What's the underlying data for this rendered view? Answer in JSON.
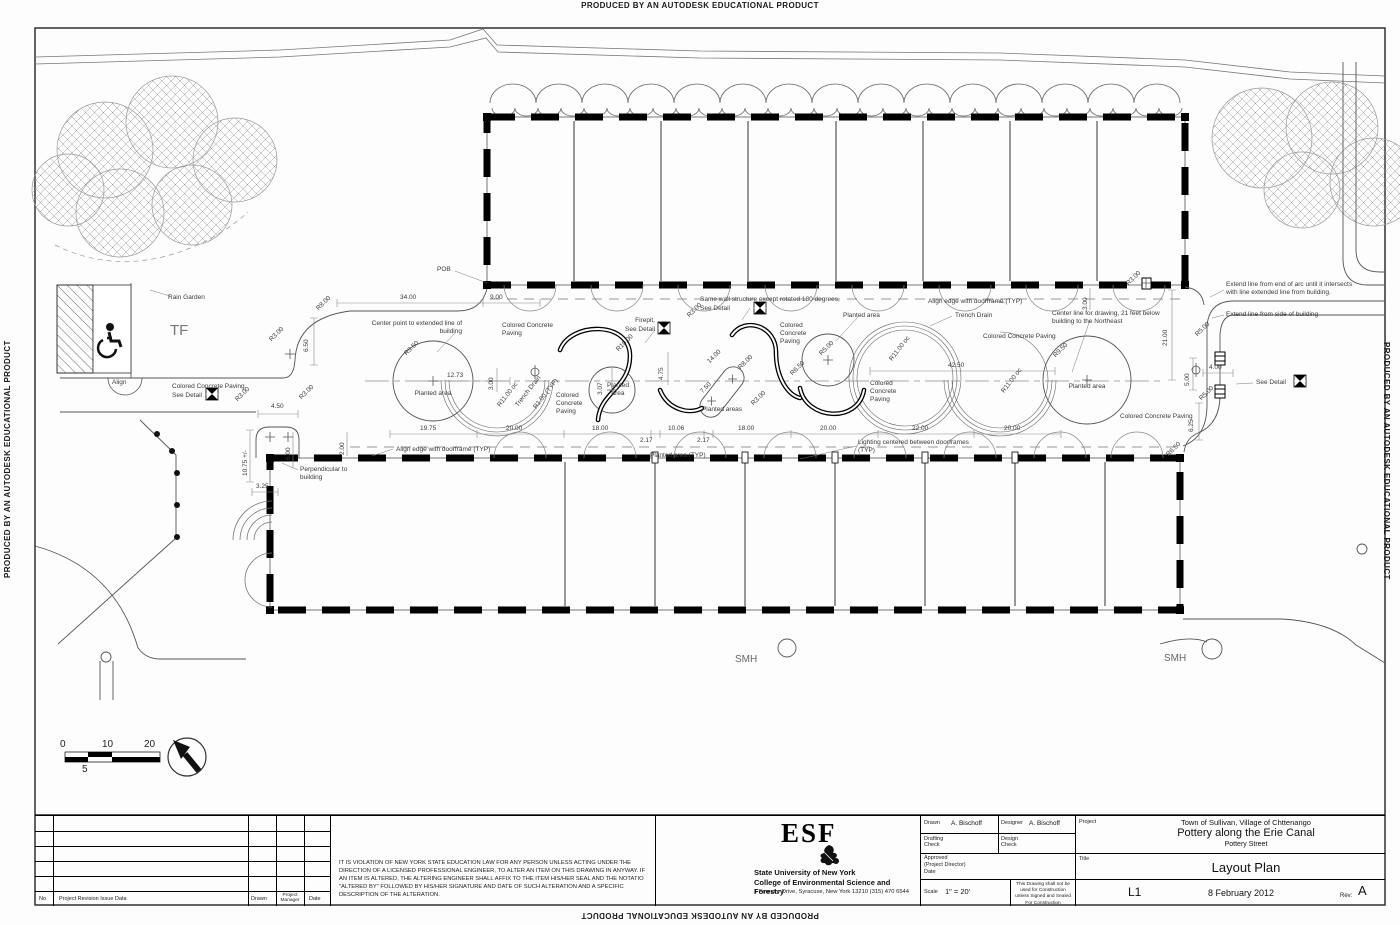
{
  "watermark": "PRODUCED BY AN AUTODESK EDUCATIONAL PRODUCT",
  "plan": {
    "labels": {
      "rain_garden": "Rain Garden",
      "tf": "TF",
      "align": "Align",
      "pob": "POB",
      "ccp": "Colored Concrete Paving",
      "see_detail": "See Detail",
      "planted_area": "Planted area",
      "planted_areas": "Planted areas",
      "planted_area_typ": "Planted area (TYP)",
      "center_point": "Center point to extended line of building",
      "firepit": "Firepit,",
      "same_wall": "Same wall structure except rotated 180 degrees,",
      "align_edge": "Align edge with doorframe (TYP)",
      "trench_drain": "Trench Drain",
      "center_line_note": "Center line for drawing, 21 feet below building to the Northeast",
      "extend_arc": "Extend line from end of arc until it intersects with line extended line from building.",
      "extend_side": "Extend line from side of building",
      "lighting": "Lighting centered between doorframes (TYP)",
      "perpendicular": "Perpendicular to building",
      "smh": "SMH"
    },
    "dims": {
      "d34": "34.00",
      "d9": "9.00",
      "d650": "6.50",
      "r8": "R8.00",
      "r3": "R3.00",
      "d450": "4.50",
      "d1075": "10.75 +/-",
      "d325": "3.25",
      "d600": "6.00",
      "d200": "2.00",
      "r950": "R9.50",
      "d1273": "12.73",
      "d300": "3.00",
      "r11oc": "R11.00 oc",
      "r1typ": "R1.00 (TYP)",
      "d1975": "19.75",
      "d2000": "20.00",
      "d1800": "18.00",
      "d217": "2.17",
      "d1006": "10.06",
      "d307": "3.07",
      "d475": "4.75",
      "r10": "R10.00",
      "d1400": "14.00",
      "d750": "7.50",
      "r5": "R5.00",
      "r650": "R6.50",
      "d4250": "42.50",
      "d2200": "22.00",
      "d2100": "21.00",
      "d500": "5.00",
      "d400": "4.00",
      "d625": "6.25"
    },
    "scalebar": {
      "n0": "0",
      "n5": "5",
      "n10": "10",
      "n20": "20"
    }
  },
  "titleblock": {
    "revision": {
      "no": "No",
      "desc": "Project Revision Issue Data",
      "drawn": "Drawn",
      "pm": "Project Manager",
      "date": "Date"
    },
    "disclaimer": "IT IS VIOLATION OF NEW YORK STATE EDUCATION LAW FOR ANY PERSON UNLESS ACTING UNDER THE DIRECTION OF A LICENSED PROFESSIONAL ENGINEER, TO ALTER AN ITEM ON THIS DRAWING IN ANYWAY.  IF AN ITEM IS ALTERED, THE ALTERING ENGINEER SHALL AFFIX TO THE ITEM HIS/HER SEAL AND THE NOTATIO \"ALTERED BY\" FOLLOWED BY HIS/HER SIGNATURE AND DATE OF SUCH ALTERATION AND A SPECIFIC DESCRIPTION OF THE ALTERATION.",
    "esf": {
      "acronym": "ESF",
      "uni": "State University of New York",
      "college": "College of Environmental Science and Forestry",
      "address": "1 Forestry Drive, Syracuse, New York  13210 (315) 470 6544"
    },
    "fields": {
      "drawn_label": "Drawn",
      "drawn_value": "A. Bischoff",
      "designer_label": "Designer",
      "designer_value": "A. Bischoff",
      "drafting_check": "Drafting Check",
      "design_check": "Design Check",
      "approved_l1": "Approved",
      "approved_l2": "(Project Director)",
      "approved_l3": "Date",
      "scale_label": "Scale",
      "scale_value": "1\" = 20'",
      "construction_note": "This Drawing shall not be used for Construction unless Signed and Sealed For Construction"
    },
    "project": {
      "label": "Project",
      "line1": "Town of Sullivan, Village of Chttenango",
      "line2": "Pottery along the Erie Canal",
      "line3": "Pottery Street",
      "title_label": "Title",
      "title": "Layout Plan",
      "sheet": "L1",
      "date": "8 February 2012",
      "rev_label": "Rev:",
      "rev": "A"
    }
  }
}
